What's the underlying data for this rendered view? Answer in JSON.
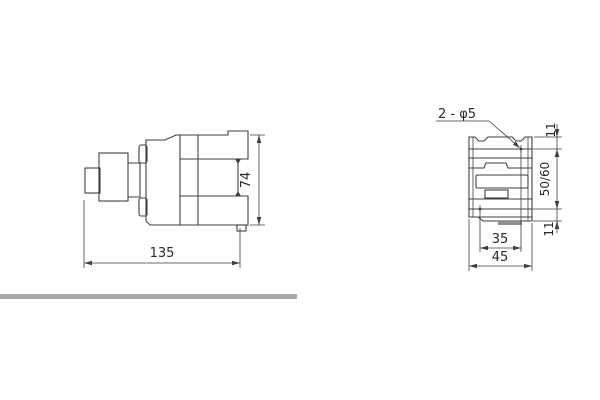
{
  "drawing": {
    "line_color": "#3f3f41",
    "text_color": "#28282a",
    "divider_bar_color": "#a8a8a8",
    "clip_fill_color": "#8f8f8f",
    "side_view": {
      "width_dim": "135",
      "height_dim": "74"
    },
    "front_view": {
      "holes_note": "2 - φ5",
      "top_offset_dim": "11",
      "rail_span_dim": "50/60",
      "bottom_offset_dim": "11",
      "hole_spacing_dim": "35",
      "width_dim": "45"
    }
  }
}
